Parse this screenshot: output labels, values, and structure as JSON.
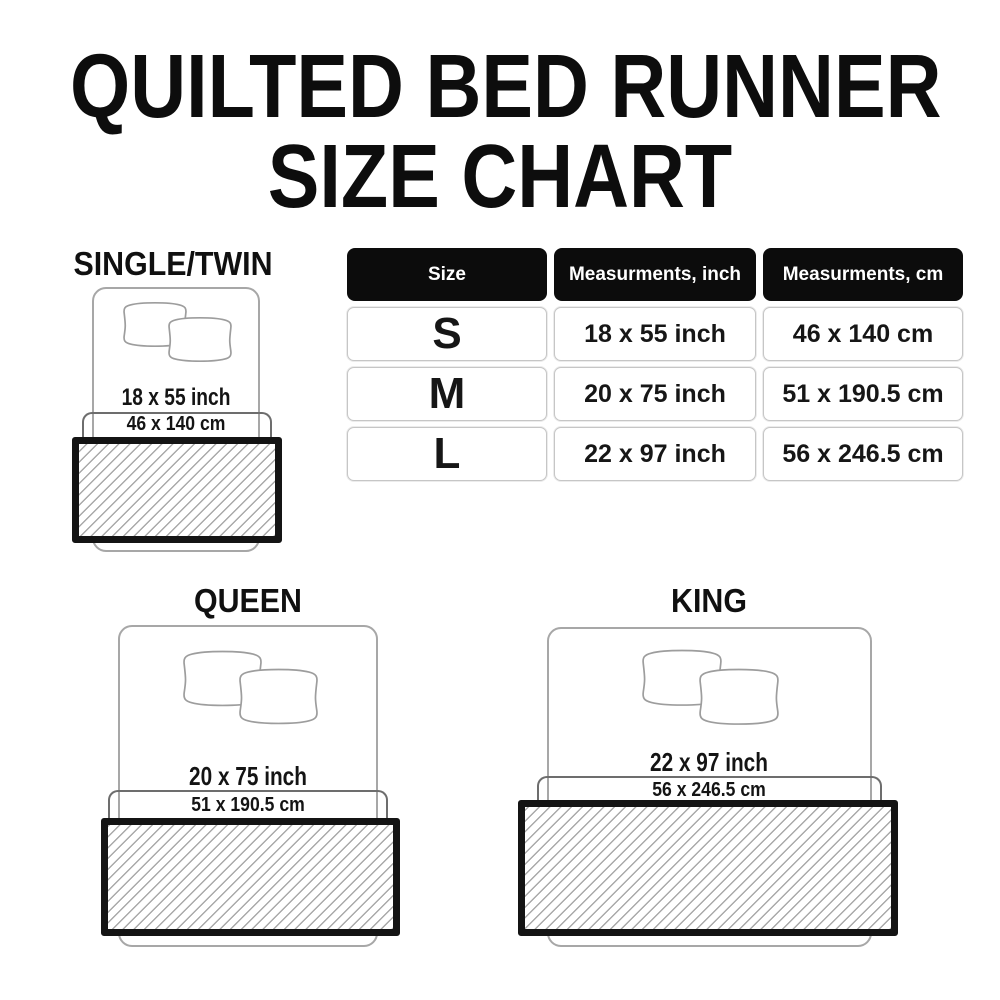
{
  "title": {
    "line1": "QUILTED BED RUNNER",
    "line2": "SIZE CHART"
  },
  "table": {
    "headers": [
      "Size",
      "Measurments, inch",
      "Measurments, cm"
    ],
    "rows": [
      {
        "size": "S",
        "inch": "18 x 55 inch",
        "cm": "46 x 140 cm"
      },
      {
        "size": "M",
        "inch": "20 x 75 inch",
        "cm": "51 x 190.5 cm"
      },
      {
        "size": "L",
        "inch": "22 x 97 inch",
        "cm": "56 x 246.5 cm"
      }
    ]
  },
  "diagrams": {
    "single": {
      "label": "SINGLE/TWIN",
      "inch": "18 x 55 inch",
      "cm": "46 x 140 cm"
    },
    "queen": {
      "label": "QUEEN",
      "inch": "20 x 75 inch",
      "cm": "51 x 190.5 cm"
    },
    "king": {
      "label": "KING",
      "inch": "22 x 97 inch",
      "cm": "56 x 246.5 cm"
    }
  },
  "colors": {
    "background": "#ffffff",
    "text": "#161616",
    "header_bg": "#0c0c0c",
    "header_text": "#ffffff",
    "cell_border": "#c6c6c6",
    "bed_outline": "#a7a7a7",
    "bracket_line": "#6d6d6d",
    "runner_border": "#141414",
    "hatch_line": "#a9a9a9"
  }
}
